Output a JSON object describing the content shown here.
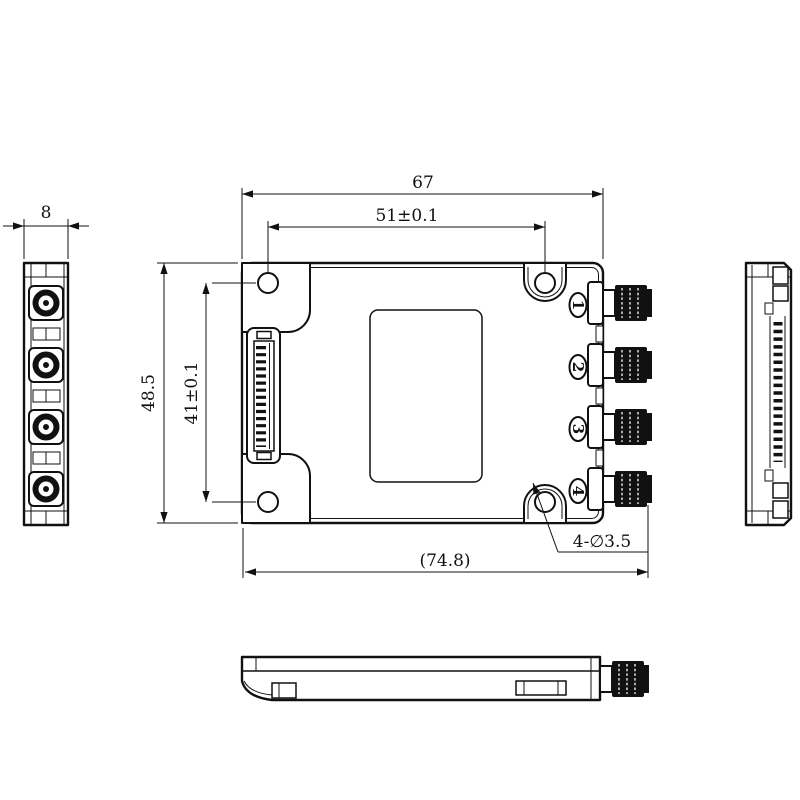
{
  "meta": {
    "type": "mechanical engineering dimension drawing",
    "subject": "RF module with 4 SMA connectors and board-to-board connector",
    "background_color": "#ffffff",
    "line_color": "#111111"
  },
  "dimensions": {
    "body_width": "67",
    "mount_hole_pitch_h": "51±0.1",
    "body_height": "48.5",
    "mount_hole_pitch_v": "41±0.1",
    "overall_width_ref": "(74.8)",
    "end_view_thickness": "8",
    "mount_hole_callout": "4-∅3.5"
  },
  "port_labels": [
    "1",
    "2",
    "3",
    "4"
  ]
}
